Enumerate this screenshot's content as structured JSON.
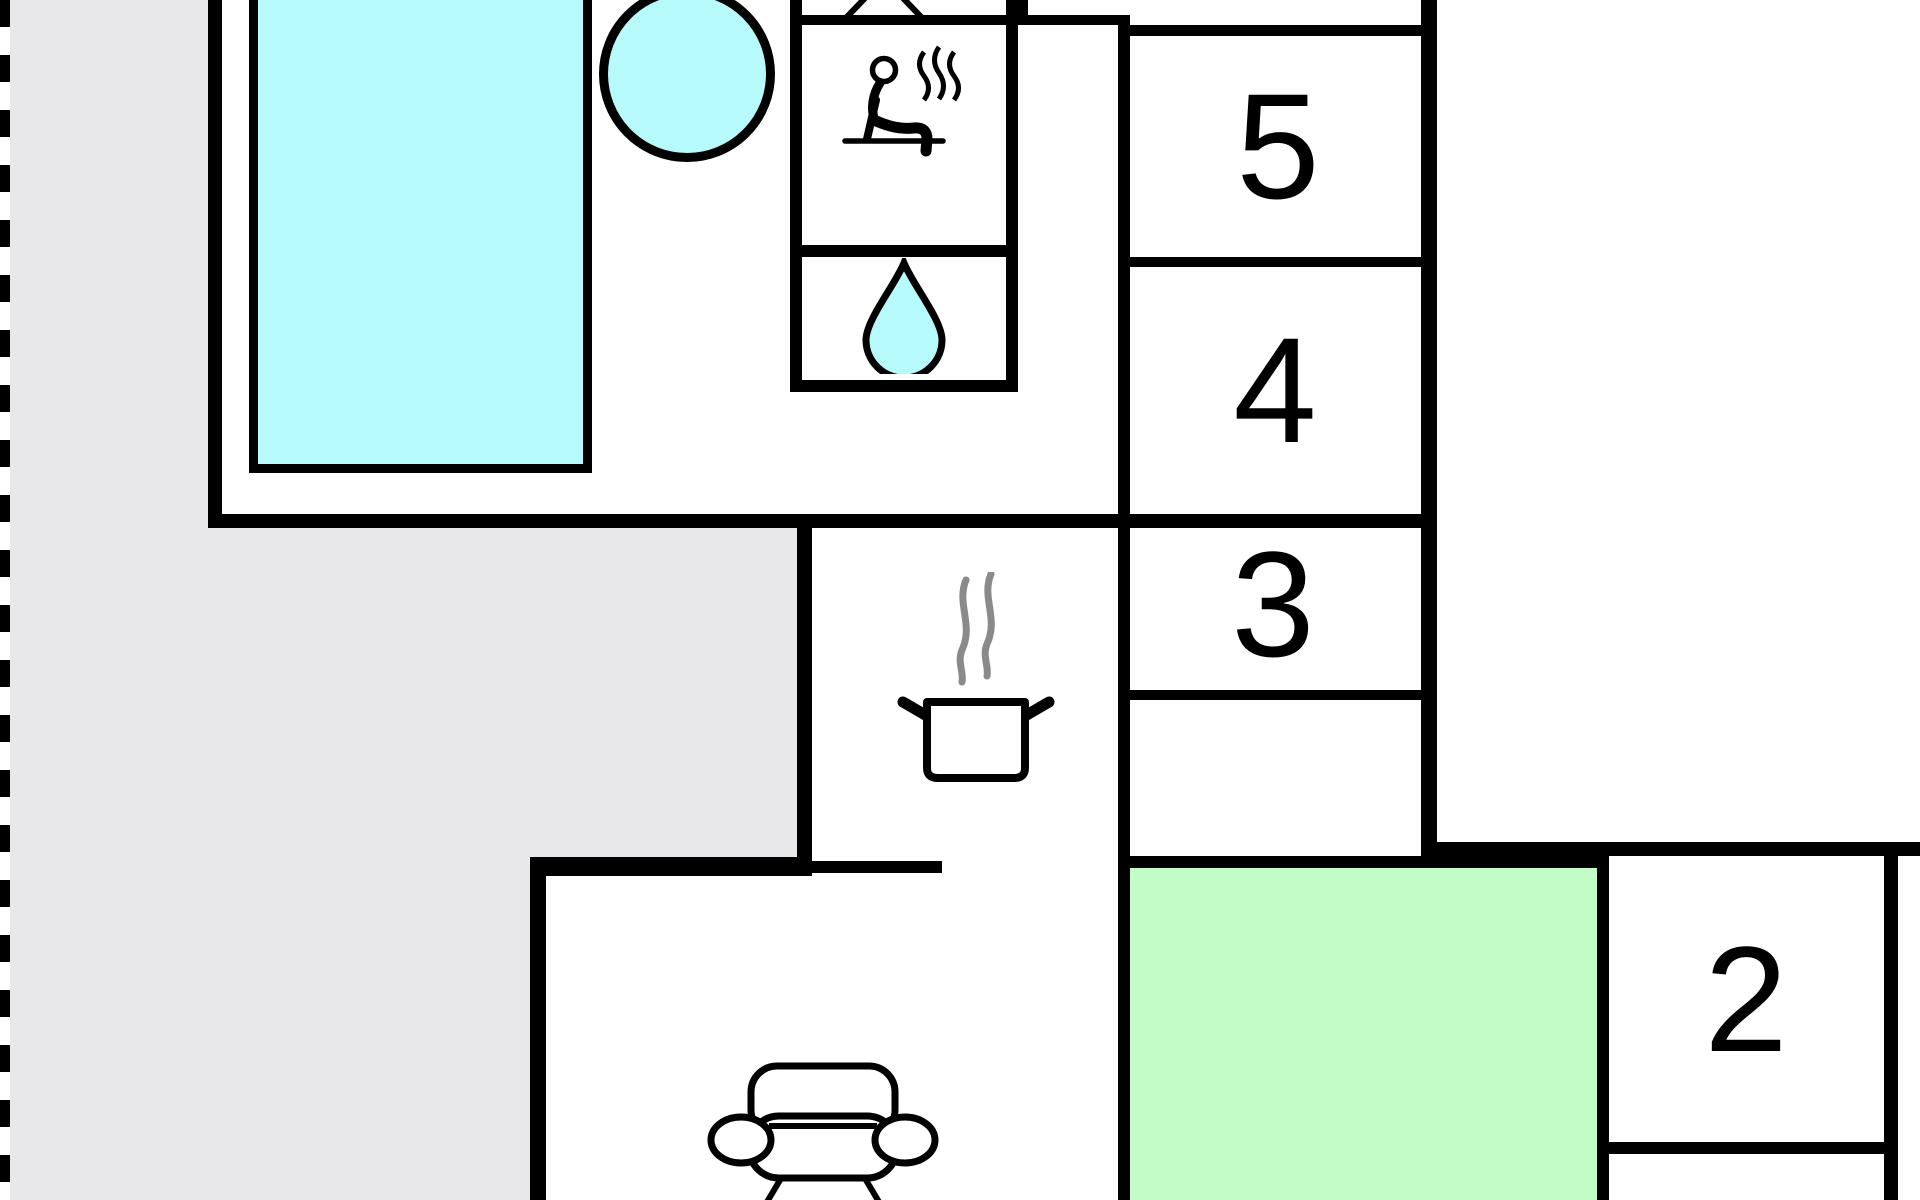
{
  "plan": {
    "type": "floor-plan",
    "rooms": [
      {
        "id": "room-5",
        "label": "5"
      },
      {
        "id": "room-4",
        "label": "4"
      },
      {
        "id": "room-3",
        "label": "3"
      },
      {
        "id": "room-2",
        "label": "2"
      }
    ],
    "features": {
      "pool": "swimming-pool",
      "hot_tub": "hot-tub",
      "sauna": "sauna-icon",
      "shower": "water-drop-icon",
      "kitchen": "cooking-pot-icon",
      "living_room": "sofa-icon",
      "partial_top": "table-icon-partial"
    },
    "colors": {
      "water": "#b6fafb",
      "green": "#c3fcc6",
      "terrace": "#e8e8eb",
      "wall": "#000000",
      "steam_gray": "#8a8a8a"
    }
  }
}
